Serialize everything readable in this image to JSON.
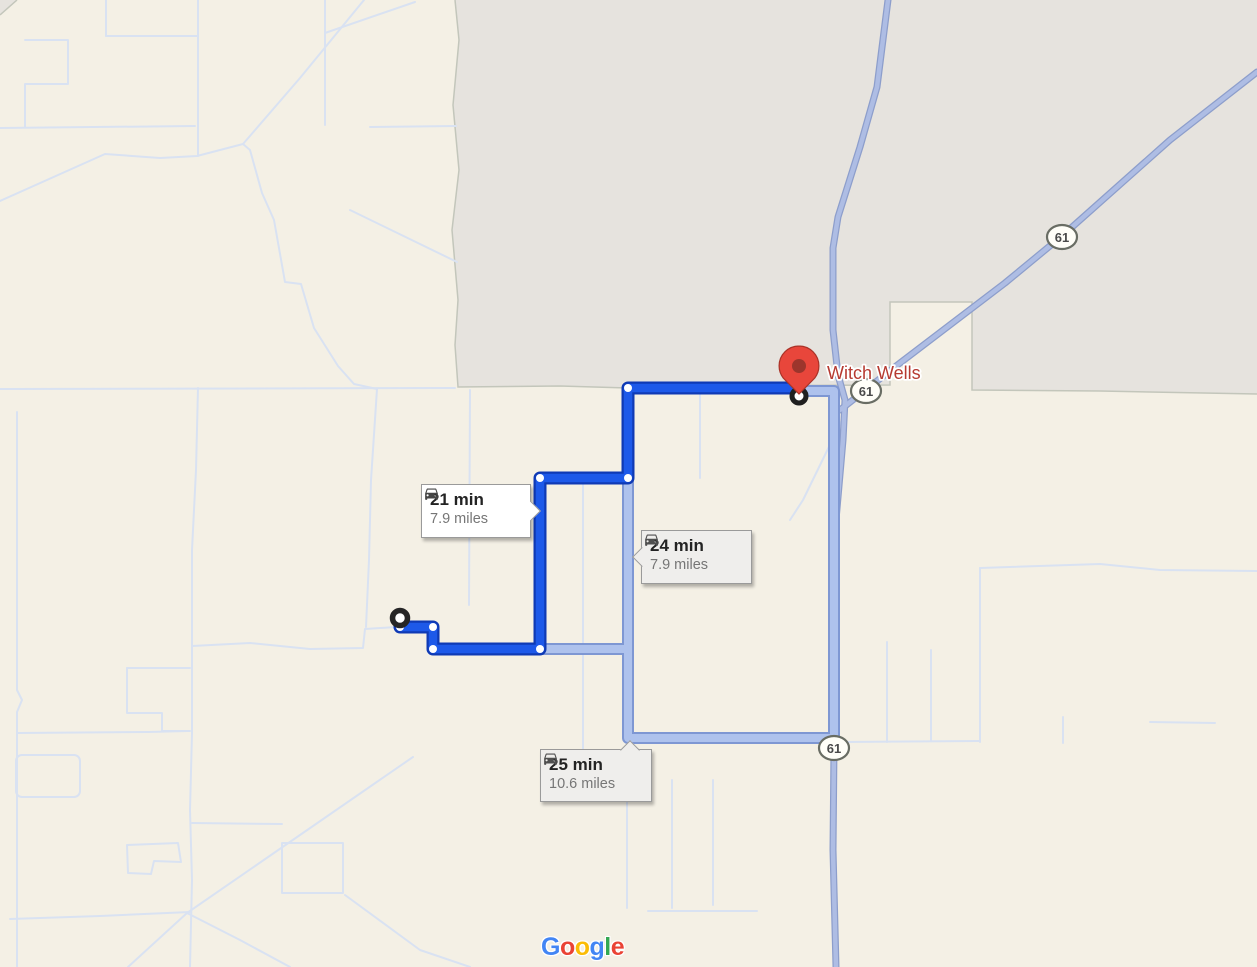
{
  "place": {
    "name": "Witch Wells",
    "label_color": "#b63a31"
  },
  "highway": {
    "shield_label": "61"
  },
  "route_options": [
    {
      "duration": "21 min",
      "distance": "7.9 miles",
      "state": "selected"
    },
    {
      "duration": "24 min",
      "distance": "7.9 miles",
      "state": "alternate"
    },
    {
      "duration": "25 min",
      "distance": "10.6 miles",
      "state": "alternate"
    }
  ],
  "colors": {
    "selected_route": "#1d59e9",
    "selected_route_casing": "#0f3ab5",
    "alternate_route": "#aec2ed",
    "alternate_route_casing": "#7e97d3",
    "destination_pin": "#e8463b",
    "land": "#f4f0e5",
    "urban_area": "#e6e3de"
  },
  "attribution": {
    "letters": [
      {
        "char": "G",
        "color": "#4285F4"
      },
      {
        "char": "o",
        "color": "#EA4335"
      },
      {
        "char": "o",
        "color": "#FBBC05"
      },
      {
        "char": "g",
        "color": "#4285F4"
      },
      {
        "char": "l",
        "color": "#34A853"
      },
      {
        "char": "e",
        "color": "#EA4335"
      }
    ]
  }
}
